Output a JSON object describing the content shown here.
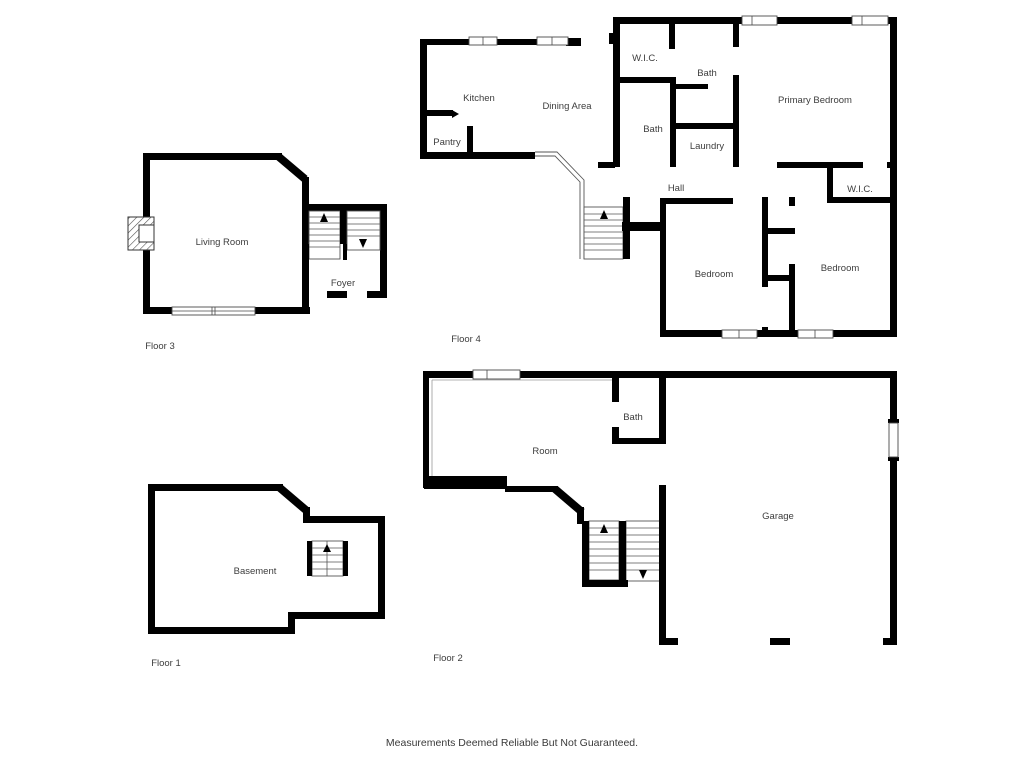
{
  "floors": [
    {
      "id": "floor3",
      "label": "Floor 3",
      "rooms": {
        "living_room": "Living Room",
        "foyer": "Foyer"
      }
    },
    {
      "id": "floor4",
      "label": "Floor 4",
      "rooms": {
        "kitchen": "Kitchen",
        "dining_area": "Dining Area",
        "pantry": "Pantry",
        "wic_upper": "W.I.C.",
        "bath_upper": "Bath",
        "primary_bedroom": "Primary Bedroom",
        "bath_lower": "Bath",
        "laundry": "Laundry",
        "hall": "Hall",
        "wic_lower": "W.I.C.",
        "bedroom_left": "Bedroom",
        "bedroom_right": "Bedroom"
      }
    },
    {
      "id": "floor1",
      "label": "Floor 1",
      "rooms": {
        "basement": "Basement"
      }
    },
    {
      "id": "floor2",
      "label": "Floor 2",
      "rooms": {
        "room": "Room",
        "bath": "Bath",
        "garage": "Garage"
      }
    }
  ],
  "disclaimer": "Measurements Deemed Reliable But Not Guaranteed.",
  "colors": {
    "wall": "#000000",
    "background": "#ffffff",
    "label_text": "#3d3d3d"
  }
}
